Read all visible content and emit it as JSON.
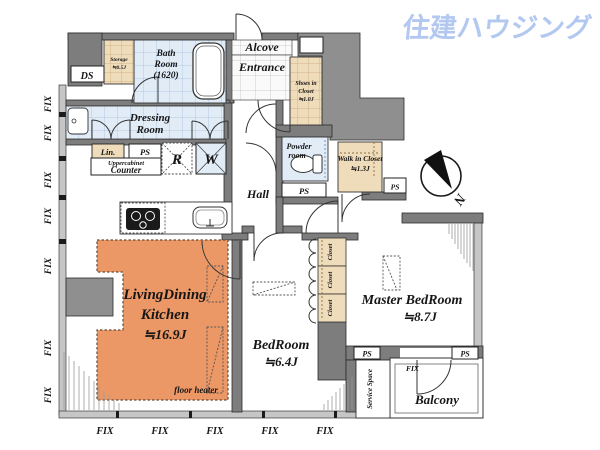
{
  "logo": {
    "text": "住建ハウジング",
    "color": "#b3c8f0"
  },
  "colors": {
    "ldk": "#ec9766",
    "tan": "#efdcba",
    "tile_blue": "#e1ecf7",
    "wall": "#7d7d7d"
  },
  "rooms": {
    "living": {
      "line1": "LivingDining",
      "line2": "Kitchen",
      "size": "≒16.9J",
      "note": "floor heater"
    },
    "bedroom": {
      "name": "BedRoom",
      "size": "≒6.4J"
    },
    "master": {
      "name": "Master BedRoom",
      "size": "≒8.7J"
    },
    "bath": {
      "line1": "Bath",
      "line2": "Room",
      "line3": "(1620)"
    },
    "dressing": {
      "line1": "Dressing",
      "line2": "Room"
    },
    "powder": {
      "line1": "Powder",
      "line2": "room"
    },
    "storage": {
      "line1": "Storage",
      "line2": "≒0.5J"
    },
    "shoes": {
      "line1": "Shoes in",
      "line2": "Closet",
      "line3": "≒1.0J"
    },
    "walkin": {
      "line1": "Walk in Closet",
      "line2": "≒1.3J"
    },
    "entrance": "Entrance",
    "alcove": "Alcove",
    "hall": "Hall",
    "balcony": "Balcony",
    "service": "Service Space",
    "closet": "Closet"
  },
  "labels": {
    "ds": "DS",
    "ps": "PS",
    "lin": "Lin.",
    "r": "R",
    "w": "W",
    "uppercabinet": "Uppercabinet",
    "counter": "Counter",
    "fix": "FIX",
    "north": "N"
  }
}
